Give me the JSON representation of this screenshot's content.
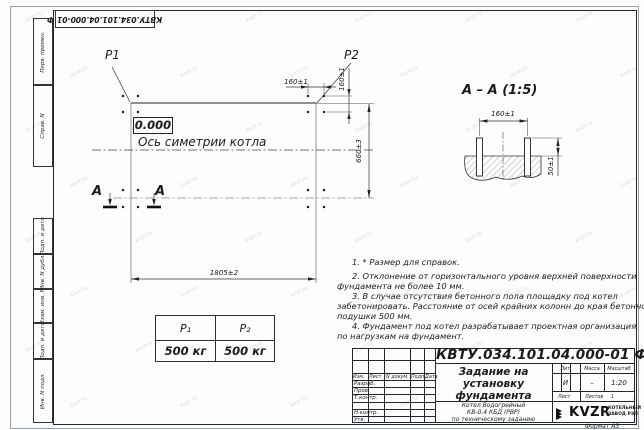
{
  "watermark": "kvzr.ru",
  "stamp_top": "КВТУ.034.101.04.000-01 Ф",
  "side_labels": [
    "Перв. примен.",
    "Справ. N",
    "Подп. и дата",
    "Инв. N дубл.",
    "Взам. инв. N",
    "Подп. и дата",
    "Инв. N подл."
  ],
  "plan": {
    "p1": "P1",
    "p2": "P2",
    "elevation": "0.000",
    "axis_label": "Ось симетрии котла",
    "dim_width": "1805±2",
    "dim_height": "660±3",
    "dim_bolt_horizontal": "160±1",
    "dim_bolt_vertical": "160±1",
    "section_letter_left": "А",
    "section_letter_right": "А"
  },
  "section_view": {
    "title": "А – А (1:5)",
    "dim_spacing": "160±1",
    "dim_protrusion": "50±1"
  },
  "load_table": {
    "headers": [
      "P₁",
      "P₂"
    ],
    "values": [
      "500 кг",
      "500 кг"
    ]
  },
  "notes": {
    "lines": [
      "1. * Размер для справок.",
      "2. Отклонение от горизонтального уровня верхней поверхности",
      "фундамента не более 10 мм.",
      "3. В случае отсутствия бетонного пола площадку под котел",
      "забетонировать. Расстояние от осей крайних колонн до края бетонной",
      "подушки 500 мм.",
      "4. Фундамент под котел разрабатывает проектная организация",
      "по нагрузкам на фундамент."
    ]
  },
  "title_block": {
    "designation": "КВТУ.034.101.04.000-01 Ф",
    "header_cols": [
      "Изм.",
      "Лист",
      "N докум.",
      "Подп.",
      "Дата"
    ],
    "rows": [
      "Разраб.",
      "Пров.",
      "Т.контр.",
      "",
      "Н.контр.",
      "Утв."
    ],
    "doc_title_lines": [
      "Задание на",
      "установку",
      "фундамента"
    ],
    "doc_subtitle_lines": [
      "Котел Водогрейный",
      "КВ-0,4  КБД  (РВР)",
      "по техническому заданию"
    ],
    "lit_label": "Лит.",
    "mass_label": "Масса",
    "scale_label": "Масштаб",
    "lit_value": "И",
    "mass_value": "–",
    "scale_value": "1:20",
    "sheet_label": "Лист",
    "sheets_label": "Листов",
    "sheets_value": "1",
    "company": "KVZR",
    "company_sub_lines": [
      "КОТЕЛЬНЫЙ",
      "ЗАВОД РЭП"
    ],
    "format_note": "Формат А3"
  },
  "colors": {
    "line": "#26262a",
    "watermark": "#b9c2cf",
    "paper": "#fdfdfd"
  }
}
